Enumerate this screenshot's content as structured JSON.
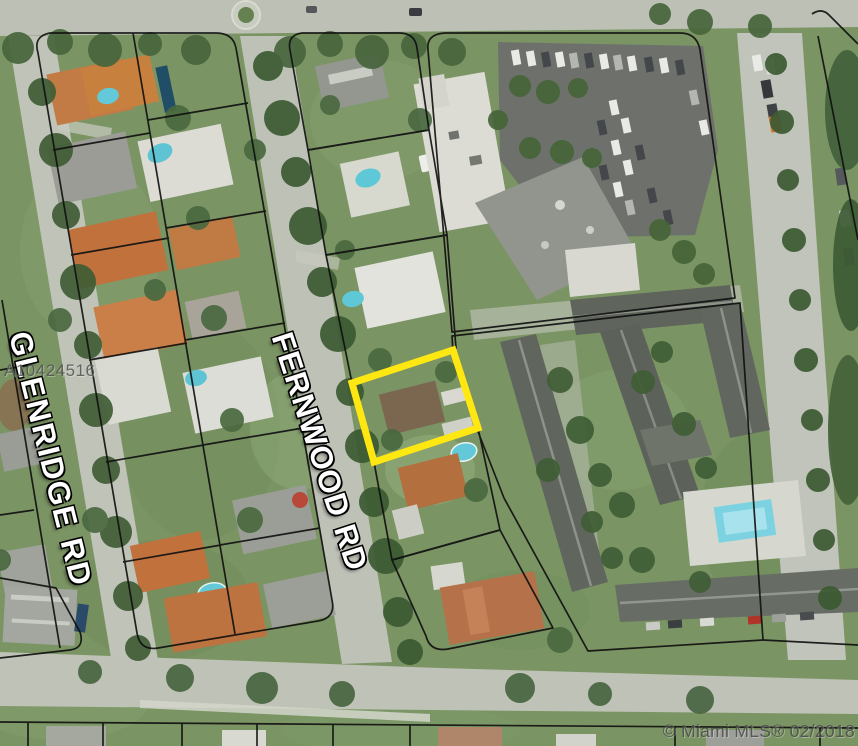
{
  "map": {
    "streets": {
      "left_vertical": "GLENRIDGE RD",
      "right_vertical": "FERNWOOD RD"
    },
    "watermarks": {
      "listing_id": "A10424516",
      "copyright": "© Miami MLS® 02/2018"
    },
    "highlight": {
      "color": "#FFE711"
    },
    "colors": {
      "parcel_boundary": "#0f0f0f",
      "road": "#bfc3b8",
      "vegetation": "#7b9464",
      "pool_water": "#63c9d8"
    }
  }
}
